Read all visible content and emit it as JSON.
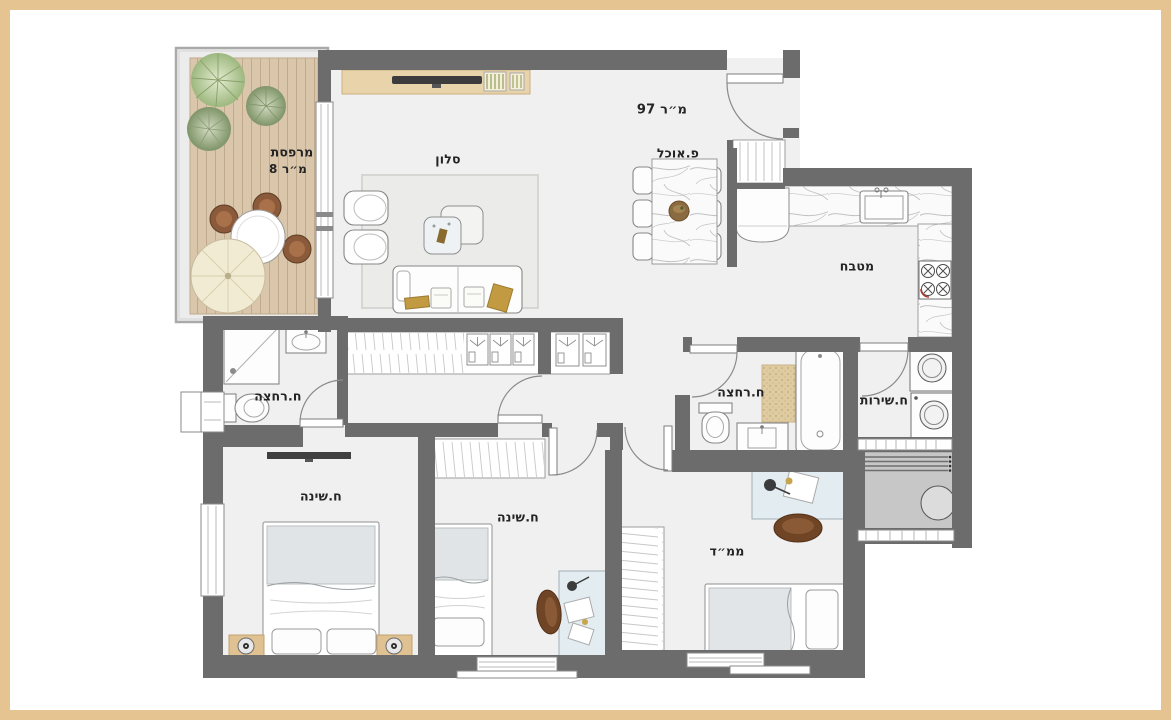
{
  "plan": {
    "labels": {
      "balcony_name": "מרפסת",
      "balcony_area": "8 מ״ר",
      "living_room": "סלון",
      "total_area": "97 מ״ר",
      "dining_nook": "פ.אוכל",
      "kitchen": "מטבח",
      "bathroom_left": "ח.רחצה",
      "bathroom_right": "ח.רחצה",
      "service_room": "ח.שירות",
      "bedroom_left": "ח.שינה",
      "bedroom_middle": "ח.שינה",
      "safe_room": "ממ״ד"
    },
    "colors": {
      "frame_border": "#e6c492",
      "walls": "#6c6c6c",
      "floor": "#f0f0f1",
      "deck_wood": "#dac6ab",
      "furniture_wood": "#dfc192",
      "chair_brown": "#8a5a3b",
      "pillow_gold": "#c19a42",
      "blanket_gray": "#e0e4e6",
      "utility_gray": "#c7c7c7",
      "plant_green": "#9db87f"
    }
  }
}
